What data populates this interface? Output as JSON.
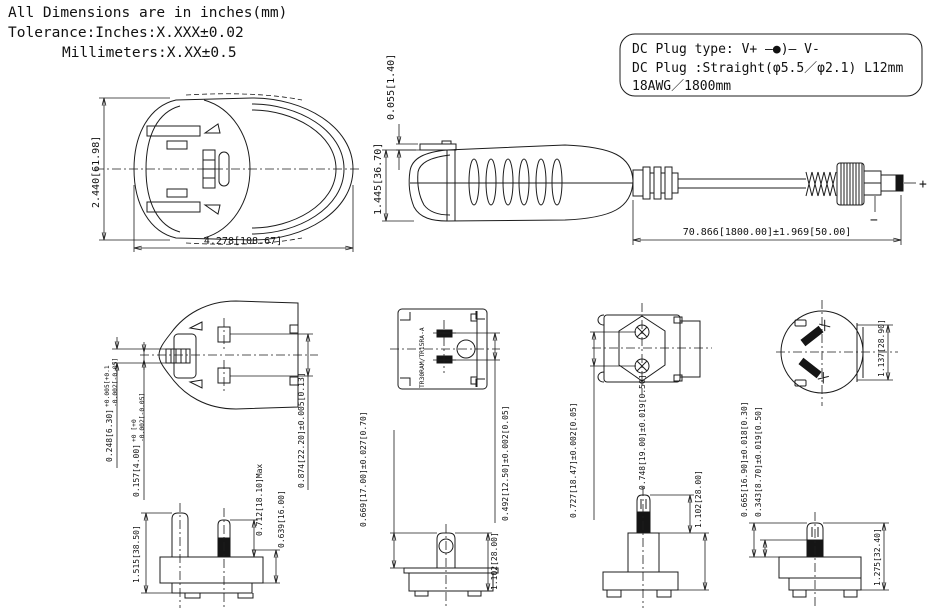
{
  "header": {
    "note1": "All Dimensions are in inches(mm)",
    "note2": "Tolerance:Inches:X.XXX±0.02",
    "note3": "Millimeters:X.XX±0.5",
    "dc1": "DC Plug type: V+ —●)— V-",
    "dc2": "DC Plug :Straight(φ5.5／φ2.1) L12mm",
    "dc3": "18AWG／1800mm"
  },
  "views": {
    "top_view": {
      "height_dim": "2.440[61.98]",
      "width_dim": "4.278[108.67]"
    },
    "side_view": {
      "clip_dim": "0.055[1.40]",
      "height_dim": "1.445[36.70]",
      "cable_dim": "70.866[1800.00]±1.969[50.00]",
      "plus": "+",
      "minus": "−"
    },
    "uk_face": {
      "pin_width": "0.248[6.30]",
      "pin_width_tol_plus": "+0.005[+0.1",
      "pin_width_tol_minus": "-0.002[-0.05]",
      "pin_thickness": "0.157[4.00]",
      "pin_thickness_tol_plus": "+0 [+0",
      "pin_thickness_tol_minus": "-0.002[-0.05]",
      "pin_pitch": "0.874[22.20]±0.005[0.13]"
    },
    "us_face": {
      "model": "TR30RAM/TR15RA-A",
      "pin_pitch": "0.492[12.50]±0.002[0.05]"
    },
    "eu_face": {
      "pin_pitch": "0.727[18.47]±0.002[0.05]"
    },
    "au_face": {
      "diameter": "1.137[28.90]"
    },
    "uk_side": {
      "total_height": "1.515[38.50]",
      "pin_length_max": "0.712[18.10]Max",
      "pin_length": "0.639[16.00]"
    },
    "us_side": {
      "pin_length": "0.669[17.00]±0.027[0.70]",
      "body_width": "1.102[28.00]"
    },
    "eu_side": {
      "pin_length": "0.748[19.00]±0.019[0.50]",
      "body_width": "1.102[28.00]"
    },
    "au_side": {
      "pin_length": "0.665[16.90]±0.018[0.30]",
      "sleeve_length": "0.343[8.70]±0.019[0.50]",
      "body_width": "1.275[32.40]"
    }
  }
}
